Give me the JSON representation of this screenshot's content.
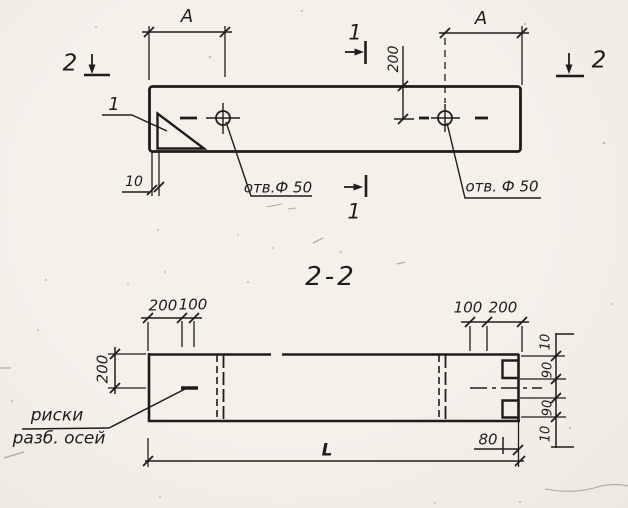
{
  "colors": {
    "ink": "#201d19",
    "paper": "#f3f1ea"
  },
  "labels": {
    "plan": {
      "dim_a_left": "А",
      "dim_a_right": "А",
      "cut2_left": "2",
      "cut2_right": "2",
      "cut1_top": "1",
      "cut1_bottom": "1",
      "detail1": "1",
      "dim_200": "200",
      "dim_10": "10",
      "hole_left": "отв.Ф 50",
      "hole_right": "отв. Ф 50"
    },
    "section": {
      "title": "2-2",
      "d200_left": "200",
      "d100_left": "100",
      "d100_right": "100",
      "d200_right": "200",
      "dim_200_side": "200",
      "risk_line1": "риски",
      "risk_line2": "разб. осей",
      "dim_l": "L",
      "dim_80": "80",
      "chain": [
        "10",
        "90",
        "90",
        "10"
      ]
    }
  }
}
